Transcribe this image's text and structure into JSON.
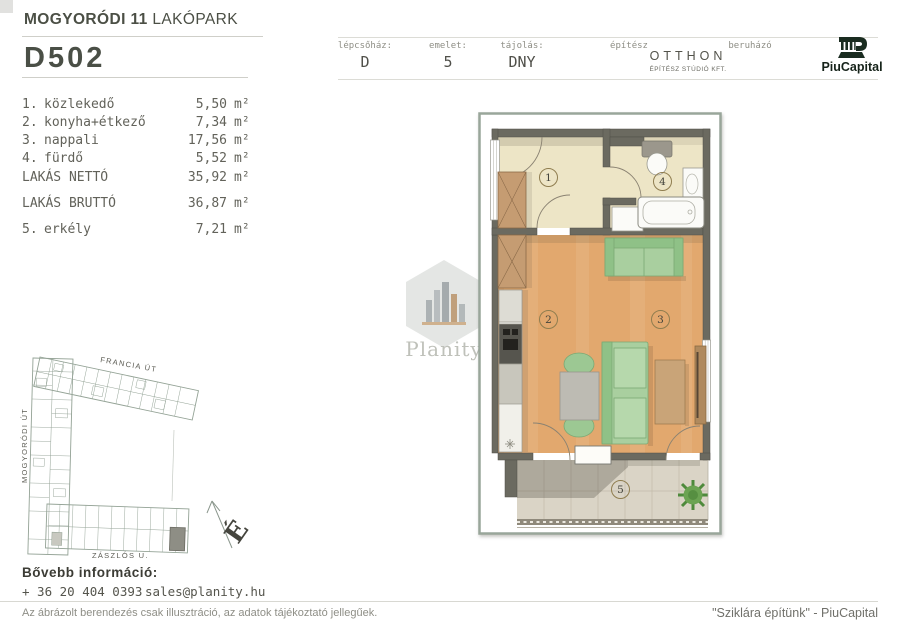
{
  "header": {
    "project_title_bold": "MOGYORÓDI 11",
    "project_title_light": "LAKÓPARK",
    "unit_id": "D502",
    "info": {
      "staircase_label": "lépcsőház:",
      "staircase_value": "D",
      "floor_label": "emelet:",
      "floor_value": "5",
      "orientation_label": "tájolás:",
      "orientation_value": "DNY",
      "architect_label": "építész",
      "architect_name": "OTTHON",
      "architect_sub": "ÉPÍTÉSZ STÚDIÓ KFT.",
      "developer_label": "beruházó",
      "developer_name": "PiuCapital"
    }
  },
  "unit": "m²",
  "rooms": [
    {
      "num": "1.",
      "name": "közlekedő",
      "area": "5,50"
    },
    {
      "num": "2.",
      "name": "konyha+étkező",
      "area": "7,34"
    },
    {
      "num": "3.",
      "name": "nappali",
      "area": "17,56"
    },
    {
      "num": "4.",
      "name": "fürdő",
      "area": "5,52"
    }
  ],
  "totals": [
    {
      "label": "LAKÁS NETTÓ",
      "area": "35,92"
    },
    {
      "label": "LAKÁS BRUTTÓ",
      "area": "36,87"
    }
  ],
  "extra_room": {
    "num": "5.",
    "name": "erkély",
    "area": "7,21"
  },
  "floorplan": {
    "markers": [
      "1",
      "2",
      "3",
      "4",
      "5"
    ]
  },
  "siteplan": {
    "street_top": "FRANCIA ÚT",
    "street_left": "MOGYORÓDI ÚT",
    "street_bottom": "ZÁSZLÓS U.",
    "north_letter": "É"
  },
  "watermark": {
    "name": "Planity"
  },
  "footer": {
    "more_info_label": "Bővebb információ:",
    "phone": "+ 36 20 404 0393",
    "email": "sales@planity.hu",
    "disclaimer": "Az ábrázolt berendezés csak illusztráció, az adatok tájékoztató jellegűek.",
    "slogan": "\"Sziklára építünk\" - PiuCapital"
  },
  "colors": {
    "accent_dark_green": "#16231a",
    "wall": "#6b6a60",
    "floor_wood": "#e2a86e",
    "floor_cream": "#ede5c6",
    "furniture_green": "#a9cf9f",
    "frame": "#99a69a"
  }
}
